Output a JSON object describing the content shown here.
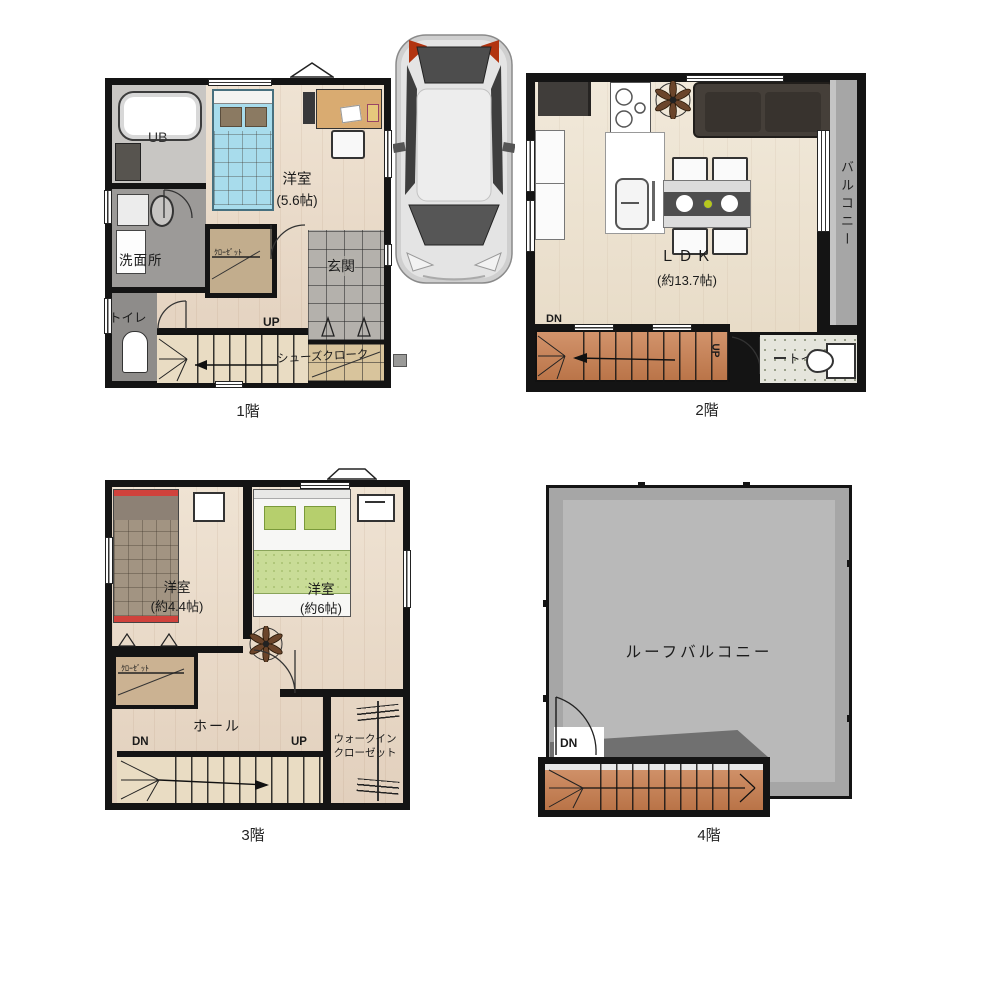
{
  "floor1": {
    "label": "1階",
    "ub": "UB",
    "washroom": "洗面所",
    "toilet": "トイレ",
    "bedroom": "洋室",
    "bedroom_size": "(5.6帖)",
    "closet": "ｸﾛｰｾﾞｯﾄ",
    "entrance": "玄関",
    "up": "UP",
    "shoes_cloak": "シューズクローク"
  },
  "floor2": {
    "label": "2階",
    "ldk": "ＬＤＫ",
    "ldk_size": "(約13.7帖)",
    "balcony": "バルコニー",
    "toilet": "トイレ",
    "dn": "DN",
    "up": "UP"
  },
  "floor3": {
    "label": "3階",
    "bedroom1": "洋室",
    "bedroom1_size": "(約4.4帖)",
    "bedroom2": "洋室",
    "bedroom2_size": "(約6帖)",
    "closet": "ｸﾛｰｾﾞｯﾄ",
    "hall": "ホール",
    "wic_line1": "ウォークイン",
    "wic_line2": "クローゼット",
    "dn": "DN",
    "up": "UP"
  },
  "floor4": {
    "label": "4階",
    "roof_balcony": "ルーフバルコニー",
    "dn": "DN"
  }
}
